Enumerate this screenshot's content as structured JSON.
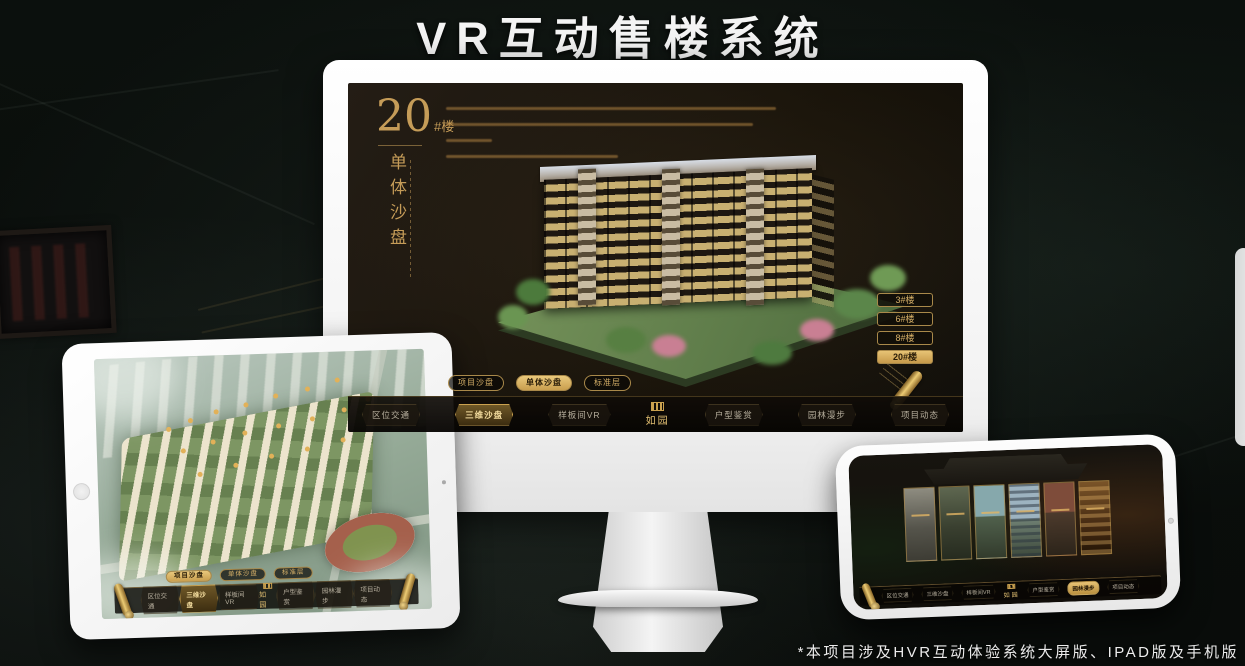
{
  "page": {
    "title": "VR互动售楼系统",
    "footnote": "*本项目涉及HVR互动体验系统大屏版、IPAD版及手机版"
  },
  "accent_color": "#d2a85e",
  "desktop_app": {
    "block": {
      "number": "20",
      "suffix": "#楼",
      "subtitle": "单体沙盘"
    },
    "floor_buttons": [
      {
        "label": "3#楼",
        "active": false
      },
      {
        "label": "6#楼",
        "active": false
      },
      {
        "label": "8#楼",
        "active": false
      },
      {
        "label": "20#楼",
        "active": true
      }
    ],
    "view_tabs": [
      {
        "label": "项目沙盘",
        "active": false
      },
      {
        "label": "单体沙盘",
        "active": true
      },
      {
        "label": "标准层",
        "active": false
      }
    ],
    "nav": {
      "logo": "如园",
      "items": [
        {
          "label": "区位交通",
          "active": false
        },
        {
          "label": "三维沙盘",
          "active": true
        },
        {
          "label": "样板间VR",
          "active": false
        },
        {
          "label": "户型鉴赏",
          "active": false
        },
        {
          "label": "园林漫步",
          "active": false
        },
        {
          "label": "项目动态",
          "active": false
        }
      ]
    }
  },
  "tablet_app": {
    "view_tabs": [
      {
        "label": "项目沙盘",
        "active": true
      },
      {
        "label": "单体沙盘",
        "active": false
      },
      {
        "label": "标准层",
        "active": false
      }
    ],
    "nav": {
      "logo": "如园",
      "items": [
        {
          "label": "区位交通",
          "active": false
        },
        {
          "label": "三维沙盘",
          "active": true
        },
        {
          "label": "样板间VR",
          "active": false
        },
        {
          "label": "户型鉴赏",
          "active": false
        },
        {
          "label": "园林漫步",
          "active": false
        },
        {
          "label": "项目动态",
          "active": false
        }
      ]
    }
  },
  "phone_app": {
    "nav": {
      "logo": "如园",
      "items": [
        {
          "label": "区位交通",
          "active": false
        },
        {
          "label": "三维沙盘",
          "active": false
        },
        {
          "label": "样板间VR",
          "active": false
        },
        {
          "label": "户型鉴赏",
          "active": false
        },
        {
          "label": "园林漫步",
          "active": true
        },
        {
          "label": "项目动态",
          "active": false
        }
      ]
    }
  }
}
